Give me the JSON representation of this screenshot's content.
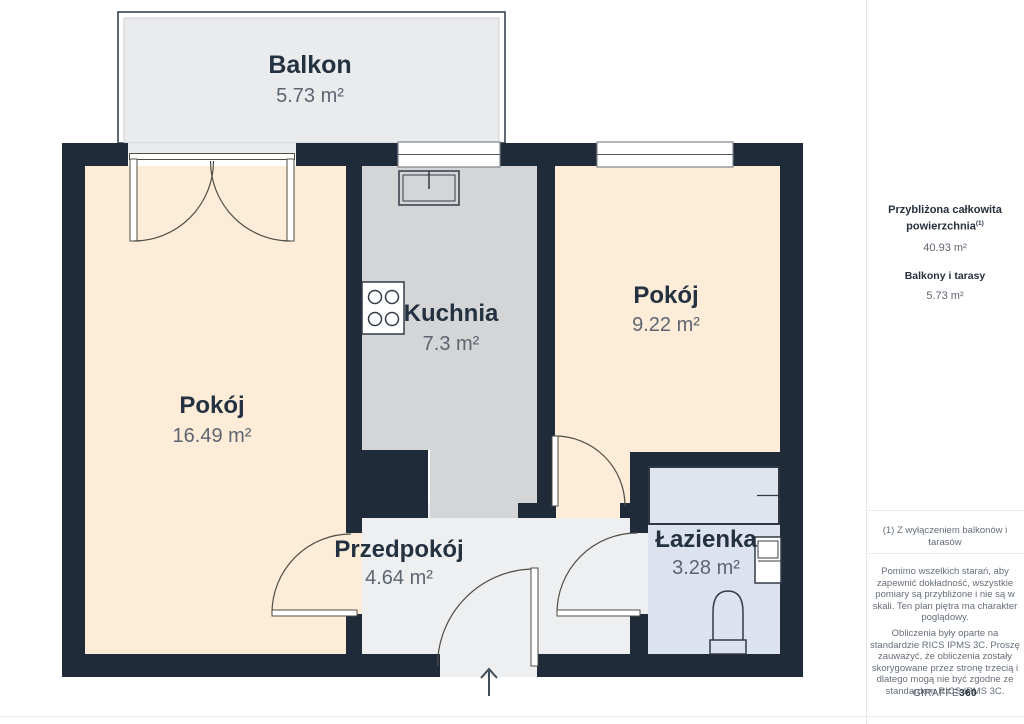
{
  "plan": {
    "rooms": [
      {
        "name": "Balkon",
        "area": "5.73 m²"
      },
      {
        "name": "Kuchnia",
        "area": "7.3 m²"
      },
      {
        "name": "Pokój",
        "area": "9.22 m²"
      },
      {
        "name": "Pokój",
        "area": "16.49 m²"
      },
      {
        "name": "Przedpokój",
        "area": "4.64 m²"
      },
      {
        "name": "Łazienka",
        "area": "3.28 m²"
      }
    ],
    "fixtures": [
      "stove",
      "kitchen-sink",
      "bathtub",
      "bathroom-sink",
      "toilet"
    ],
    "entry_arrow": "up"
  },
  "sidebar": {
    "total_label_line1": "Przybliżona całkowita",
    "total_label_line2": "powierzchnia",
    "total_footnote_marker": "(1)",
    "total_value": "40.93 m²",
    "balconies_label": "Balkony i tarasy",
    "balconies_value": "5.73 m²",
    "footnote": "(1) Z wyłączeniem balkonów i tarasów",
    "disclaimer1": "Pomimo wszelkich starań, aby zapewnić dokładność, wszystkie pomiary są przybliżone i nie są w skali. Ten plan piętra ma charakter poglądowy.",
    "disclaimer2": "Obliczenia były oparte na standardzie RICS IPMS 3C. Proszę zauważyć, że obliczenia zostały skorygowane przez stronę trzecią i dlatego mogą nie być zgodne ze standardem RICS IPMS 3C.",
    "brand_name": "GIRAFFE",
    "brand_number": "360"
  },
  "colors": {
    "wall": "#1f2b39",
    "room_floor": "#fdecd7",
    "kitchen_floor": "#d4d5d6",
    "hallway_floor": "#edeff1",
    "bathroom_floor": "#dce2ee",
    "balcony_floor": "#e9ebed",
    "room_label": "#243140",
    "area_label": "#5d6571"
  }
}
